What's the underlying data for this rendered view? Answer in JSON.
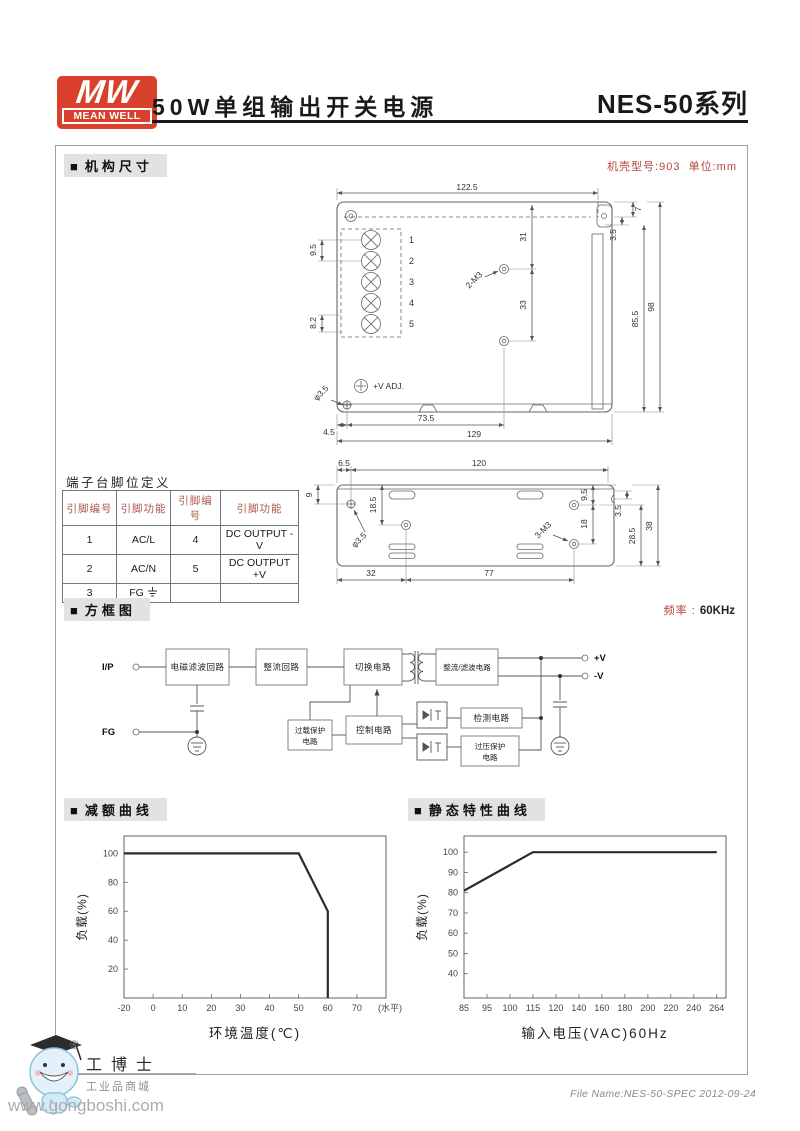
{
  "ui": {
    "bullet": "■"
  },
  "colors": {
    "brand_red": "#d9402c",
    "note_red": "#b5443a",
    "curve": "#2b2b2b"
  },
  "header": {
    "logo_top": "MW",
    "logo_bottom": "MEAN WELL",
    "title": "50W单组输出开关电源",
    "series": "NES-50",
    "series_suffix": "系列"
  },
  "mech": {
    "section": "机构尺寸",
    "note_model": "机壳型号:903",
    "note_unit": "单位:mm",
    "top": {
      "dim_w": "122.5",
      "dim_7": "7",
      "dim_35": "3.5",
      "dim_31": "31",
      "dim_33": "33",
      "dim_855": "85.5",
      "dim_98": "98",
      "dim_95": "9.5",
      "dim_82": "8.2",
      "hole": "2-M3",
      "phi": "φ3.5",
      "vadj": "+V ADJ.",
      "dim_45": "4.5",
      "dim_735": "73.5",
      "dim_129": "129",
      "pins": [
        "1",
        "2",
        "3",
        "4",
        "5"
      ]
    },
    "bottom": {
      "dim_65": "6.5",
      "dim_120": "120",
      "dim_9": "9",
      "dim_185": "18.5",
      "phi": "φ3.5",
      "m3": "3-M3",
      "dim_95": "9.5",
      "dim_18": "18",
      "dim_35": "3.5",
      "dim_285": "28.5",
      "dim_38": "38",
      "dim_32": "32",
      "dim_77": "77"
    }
  },
  "terminal_table": {
    "title": "端子台脚位定义",
    "headers": [
      "引脚编号",
      "引脚功能",
      "引脚编号",
      "引脚功能"
    ],
    "rows": [
      [
        "1",
        "AC/L",
        "4",
        "DC OUTPUT -V"
      ],
      [
        "2",
        "AC/N",
        "5",
        "DC OUTPUT +V"
      ],
      [
        "3",
        "FG",
        "",
        ""
      ]
    ]
  },
  "block": {
    "section": "方框图",
    "freq_label": "频率 :",
    "freq_value": "60KHz",
    "ip": "I/P",
    "fg": "FG",
    "vp": "+V",
    "vm": "-V",
    "b_emi": "电磁滤波回路",
    "b_rect": "整流回路",
    "b_sw": "切换电路",
    "b_out": "整流/滤波电路",
    "b_olp1": "过载保护",
    "b_olp2": "电路",
    "b_ctrl": "控制电路",
    "b_det": "检测电路",
    "b_ovp1": "过压保护",
    "b_ovp2": "电路"
  },
  "charts": {
    "derating": {
      "section": "减额曲线",
      "type": "line",
      "xlabel": "环境温度(℃)",
      "ylabel": "负载(%)",
      "xticks": [
        -20,
        0,
        10,
        20,
        30,
        40,
        50,
        60,
        70
      ],
      "x_extra_label": "(水平)",
      "x_extra_gaps": 1,
      "yticks": [
        20,
        40,
        60,
        80,
        100
      ],
      "ymin": 0,
      "ymax": 112,
      "points": [
        [
          0,
          100
        ],
        [
          6,
          100
        ],
        [
          7,
          60
        ],
        [
          7,
          0
        ]
      ],
      "line_color": "#2b2b2b"
    },
    "static": {
      "section": "静态特性曲线",
      "type": "line",
      "xlabel": "输入电压(VAC)60Hz",
      "ylabel": "负载(%)",
      "xticks": [
        85,
        95,
        100,
        115,
        120,
        140,
        160,
        180,
        200,
        220,
        240,
        264
      ],
      "x_extra_gaps": 0.4,
      "yticks": [
        40,
        50,
        60,
        70,
        80,
        90,
        100
      ],
      "ymin": 28,
      "ymax": 108,
      "points": [
        [
          0,
          81
        ],
        [
          3,
          100
        ],
        [
          11,
          100
        ]
      ],
      "line_color": "#2b2b2b"
    }
  },
  "watermark": {
    "reg": "®",
    "brand": "工博士",
    "tagline": "工业品商城",
    "url": "www.gongboshi.com"
  },
  "footer": {
    "file_name": "File Name:NES-50-SPEC  2012-09-24"
  }
}
